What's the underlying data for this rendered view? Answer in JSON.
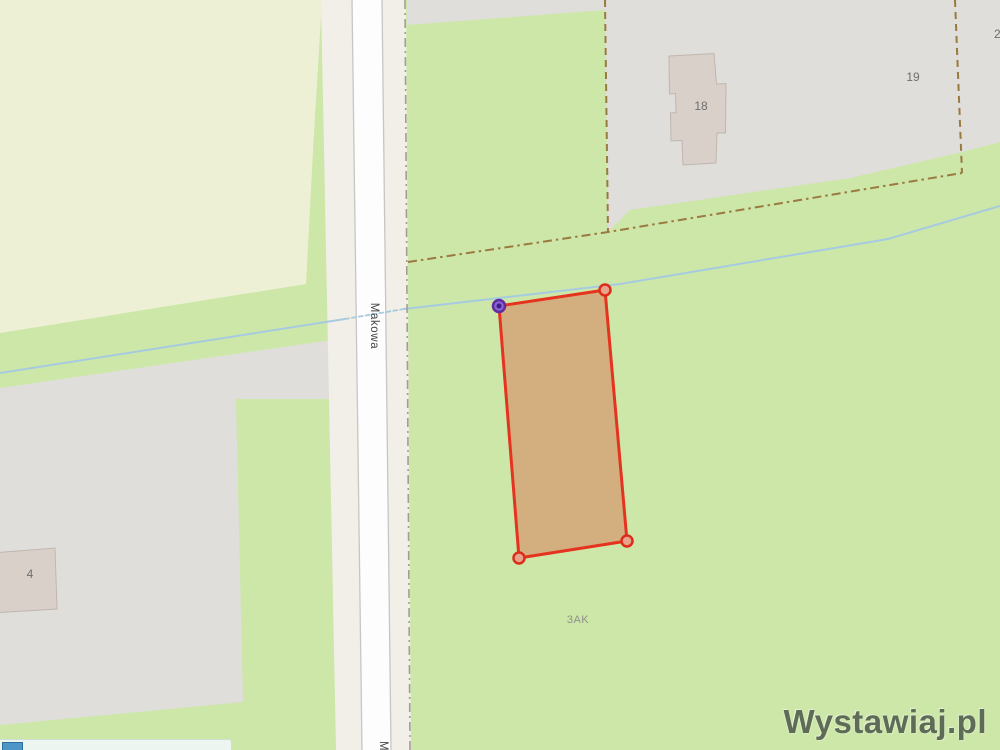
{
  "page": {
    "type": "map-viewport"
  },
  "street": {
    "name": "Makowa"
  },
  "labels": {
    "building_18": "18",
    "building_19": "19",
    "building_right_edge_partial": "2",
    "building_4": "4",
    "area_code": "3AK"
  },
  "watermark": {
    "text": "Wystawiaj.pl"
  },
  "icons": {
    "parcel_vertex_selected": "purple-vertex-handle-icon",
    "parcel_vertex": "red-vertex-handle-icon"
  },
  "colors": {
    "grass": "#cde7a9",
    "farmland": "#eef0d5",
    "residential": "#dfdedb",
    "land": "#f2efe9",
    "road": "#fdfdfd",
    "road_casing": "#c6c6c6",
    "building": "#d9d0c9",
    "building_stroke": "#c0b6ad",
    "stream": "#a6cbe0",
    "track": "#9a7a3e",
    "roadside_boundary": "#a39d96",
    "parcel_fill": "#d3ae7e",
    "parcel_stroke": "#e63320",
    "vertex_red": "#dd2d1a",
    "vertex_red_fill": "#e8a38c",
    "vertex_purple_stroke": "#5f2d9c",
    "vertex_purple_fill": "#8a63d2",
    "vertex_purple_core": "#3f1d85",
    "street_label": "#454545",
    "area_label": "#8f9189",
    "housenumber": "#6e6e6e",
    "watermark": "#5d6b57",
    "bar_bg": "#edf5f0",
    "bar_border": "#cfdfd3",
    "bar_button": "#4e96c5",
    "bar_button_border": "#2d6f9e"
  }
}
